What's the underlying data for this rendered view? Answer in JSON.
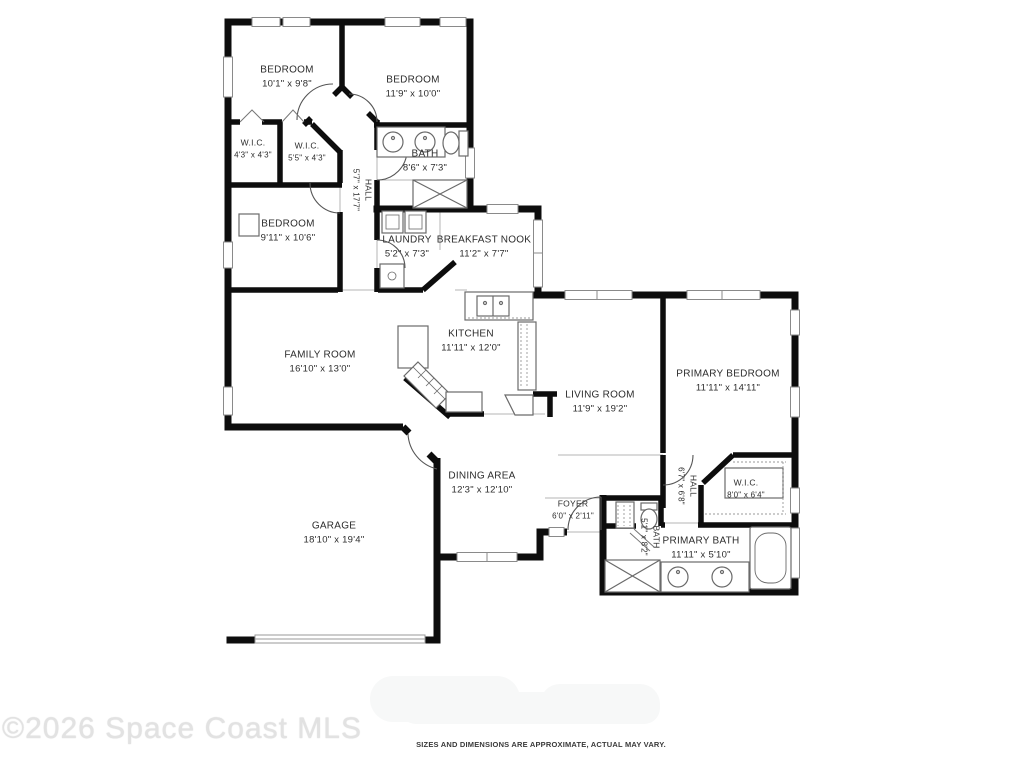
{
  "plan": {
    "wall_color": "#0d0d0d",
    "window_line_color": "#8a8a8a",
    "fixture_line_color": "#6a6a6a",
    "label_color": "#2c2c2c",
    "rooms": [
      {
        "id": "bedroom-1",
        "name": "BEDROOM",
        "dims": "10'1\" x 9'8\"",
        "x": 287,
        "y": 77,
        "rotate": false,
        "small": false
      },
      {
        "id": "bedroom-2",
        "name": "BEDROOM",
        "dims": "11'9\" x 10'0\"",
        "x": 413,
        "y": 87,
        "rotate": false,
        "small": false
      },
      {
        "id": "wic-1",
        "name": "W.I.C.",
        "dims": "4'3\" x 4'3\"",
        "x": 253,
        "y": 149,
        "rotate": false,
        "small": true
      },
      {
        "id": "wic-2",
        "name": "W.I.C.",
        "dims": "5'5\" x 4'3\"",
        "x": 307,
        "y": 152,
        "rotate": false,
        "small": true
      },
      {
        "id": "bath",
        "name": "BATH",
        "dims": "8'6\" x 7'3\"",
        "x": 425,
        "y": 161,
        "rotate": false,
        "small": false
      },
      {
        "id": "hall-1",
        "name": "HALL",
        "dims": "5'7\" x 17'7\"",
        "x": 362,
        "y": 190,
        "rotate": true,
        "small": true
      },
      {
        "id": "bedroom-3",
        "name": "BEDROOM",
        "dims": "9'11\" x 10'6\"",
        "x": 288,
        "y": 231,
        "rotate": false,
        "small": false
      },
      {
        "id": "laundry",
        "name": "LAUNDRY",
        "dims": "5'2\" x 7'3\"",
        "x": 407,
        "y": 247,
        "rotate": false,
        "small": false
      },
      {
        "id": "breakfast-nook",
        "name": "BREAKFAST NOOK",
        "dims": "11'2\" x 7'7\"",
        "x": 484,
        "y": 247,
        "rotate": false,
        "small": false
      },
      {
        "id": "kitchen",
        "name": "KITCHEN",
        "dims": "11'11\" x 12'0\"",
        "x": 471,
        "y": 341,
        "rotate": false,
        "small": false
      },
      {
        "id": "family-room",
        "name": "FAMILY ROOM",
        "dims": "16'10\" x 13'0\"",
        "x": 320,
        "y": 362,
        "rotate": false,
        "small": false
      },
      {
        "id": "living-room",
        "name": "LIVING ROOM",
        "dims": "11'9\" x 19'2\"",
        "x": 600,
        "y": 402,
        "rotate": false,
        "small": false
      },
      {
        "id": "primary-bedroom",
        "name": "PRIMARY BEDROOM",
        "dims": "11'11\" x 14'11\"",
        "x": 728,
        "y": 381,
        "rotate": false,
        "small": false
      },
      {
        "id": "dining-area",
        "name": "DINING AREA",
        "dims": "12'3\" x 12'10\"",
        "x": 482,
        "y": 483,
        "rotate": false,
        "small": false
      },
      {
        "id": "garage",
        "name": "GARAGE",
        "dims": "18'10\" x 19'4\"",
        "x": 334,
        "y": 533,
        "rotate": false,
        "small": false
      },
      {
        "id": "foyer",
        "name": "FOYER",
        "dims": "6'0\" x 2'11\"",
        "x": 573,
        "y": 510,
        "rotate": false,
        "small": true
      },
      {
        "id": "hall-2",
        "name": "HALL",
        "dims": "6'7\" x 6'8\"",
        "x": 687,
        "y": 486,
        "rotate": true,
        "small": true
      },
      {
        "id": "wic-3",
        "name": "W.I.C.",
        "dims": "8'0\" x 6'4\"",
        "x": 746,
        "y": 489,
        "rotate": false,
        "small": true
      },
      {
        "id": "bath-2",
        "name": "BATH",
        "dims": "5'1\" x 8'2\"",
        "x": 650,
        "y": 537,
        "rotate": true,
        "small": true
      },
      {
        "id": "primary-bath",
        "name": "PRIMARY BATH",
        "dims": "11'11\" x 5'10\"",
        "x": 701,
        "y": 548,
        "rotate": false,
        "small": false
      }
    ]
  },
  "footer": {
    "copyright": "©2026 Space Coast MLS",
    "disclaimer": "SIZES AND DIMENSIONS ARE APPROXIMATE, ACTUAL MAY VARY."
  }
}
